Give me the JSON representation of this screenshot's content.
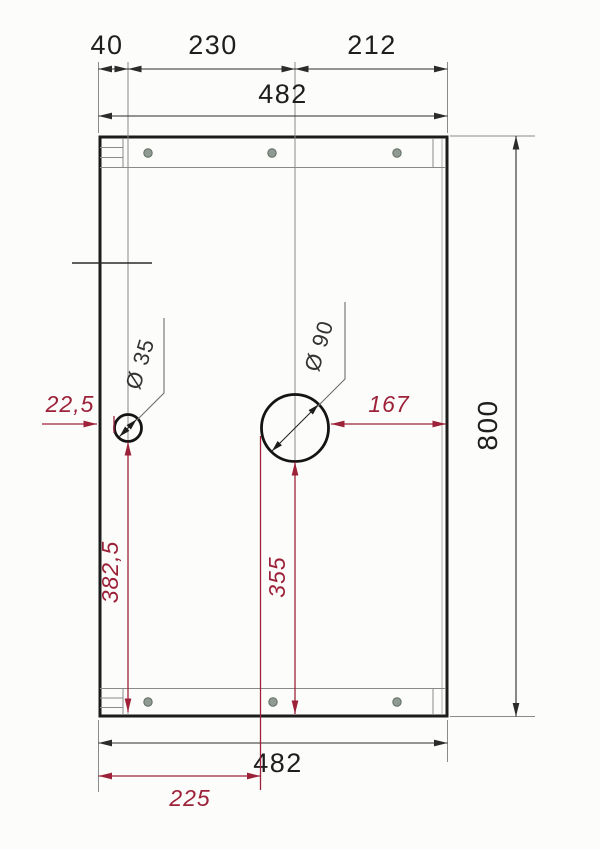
{
  "drawing": {
    "type": "technical-panel-drawing",
    "units": "mm",
    "panel": {
      "width_label": "482",
      "height_label": "800"
    },
    "dims": {
      "top_40": "40",
      "top_230": "230",
      "top_212": "212",
      "top_482": "482",
      "right_800": "800",
      "bottom_482": "482",
      "bottom_225": "225",
      "left_22_5": "22,5",
      "right_167": "167",
      "vert_382_5": "382,5",
      "vert_355": "355"
    },
    "callouts": {
      "small_hole_diameter": "Ø 35",
      "large_hole_diameter": "Ø 90"
    },
    "colors": {
      "background": "#fcfcfa",
      "line_black": "#1c1c1c",
      "dim_red": "#9c2139",
      "screw_hole": "#8e9a92"
    },
    "screw_holes": {
      "top_row_count": 3,
      "bottom_row_count": 3
    }
  }
}
